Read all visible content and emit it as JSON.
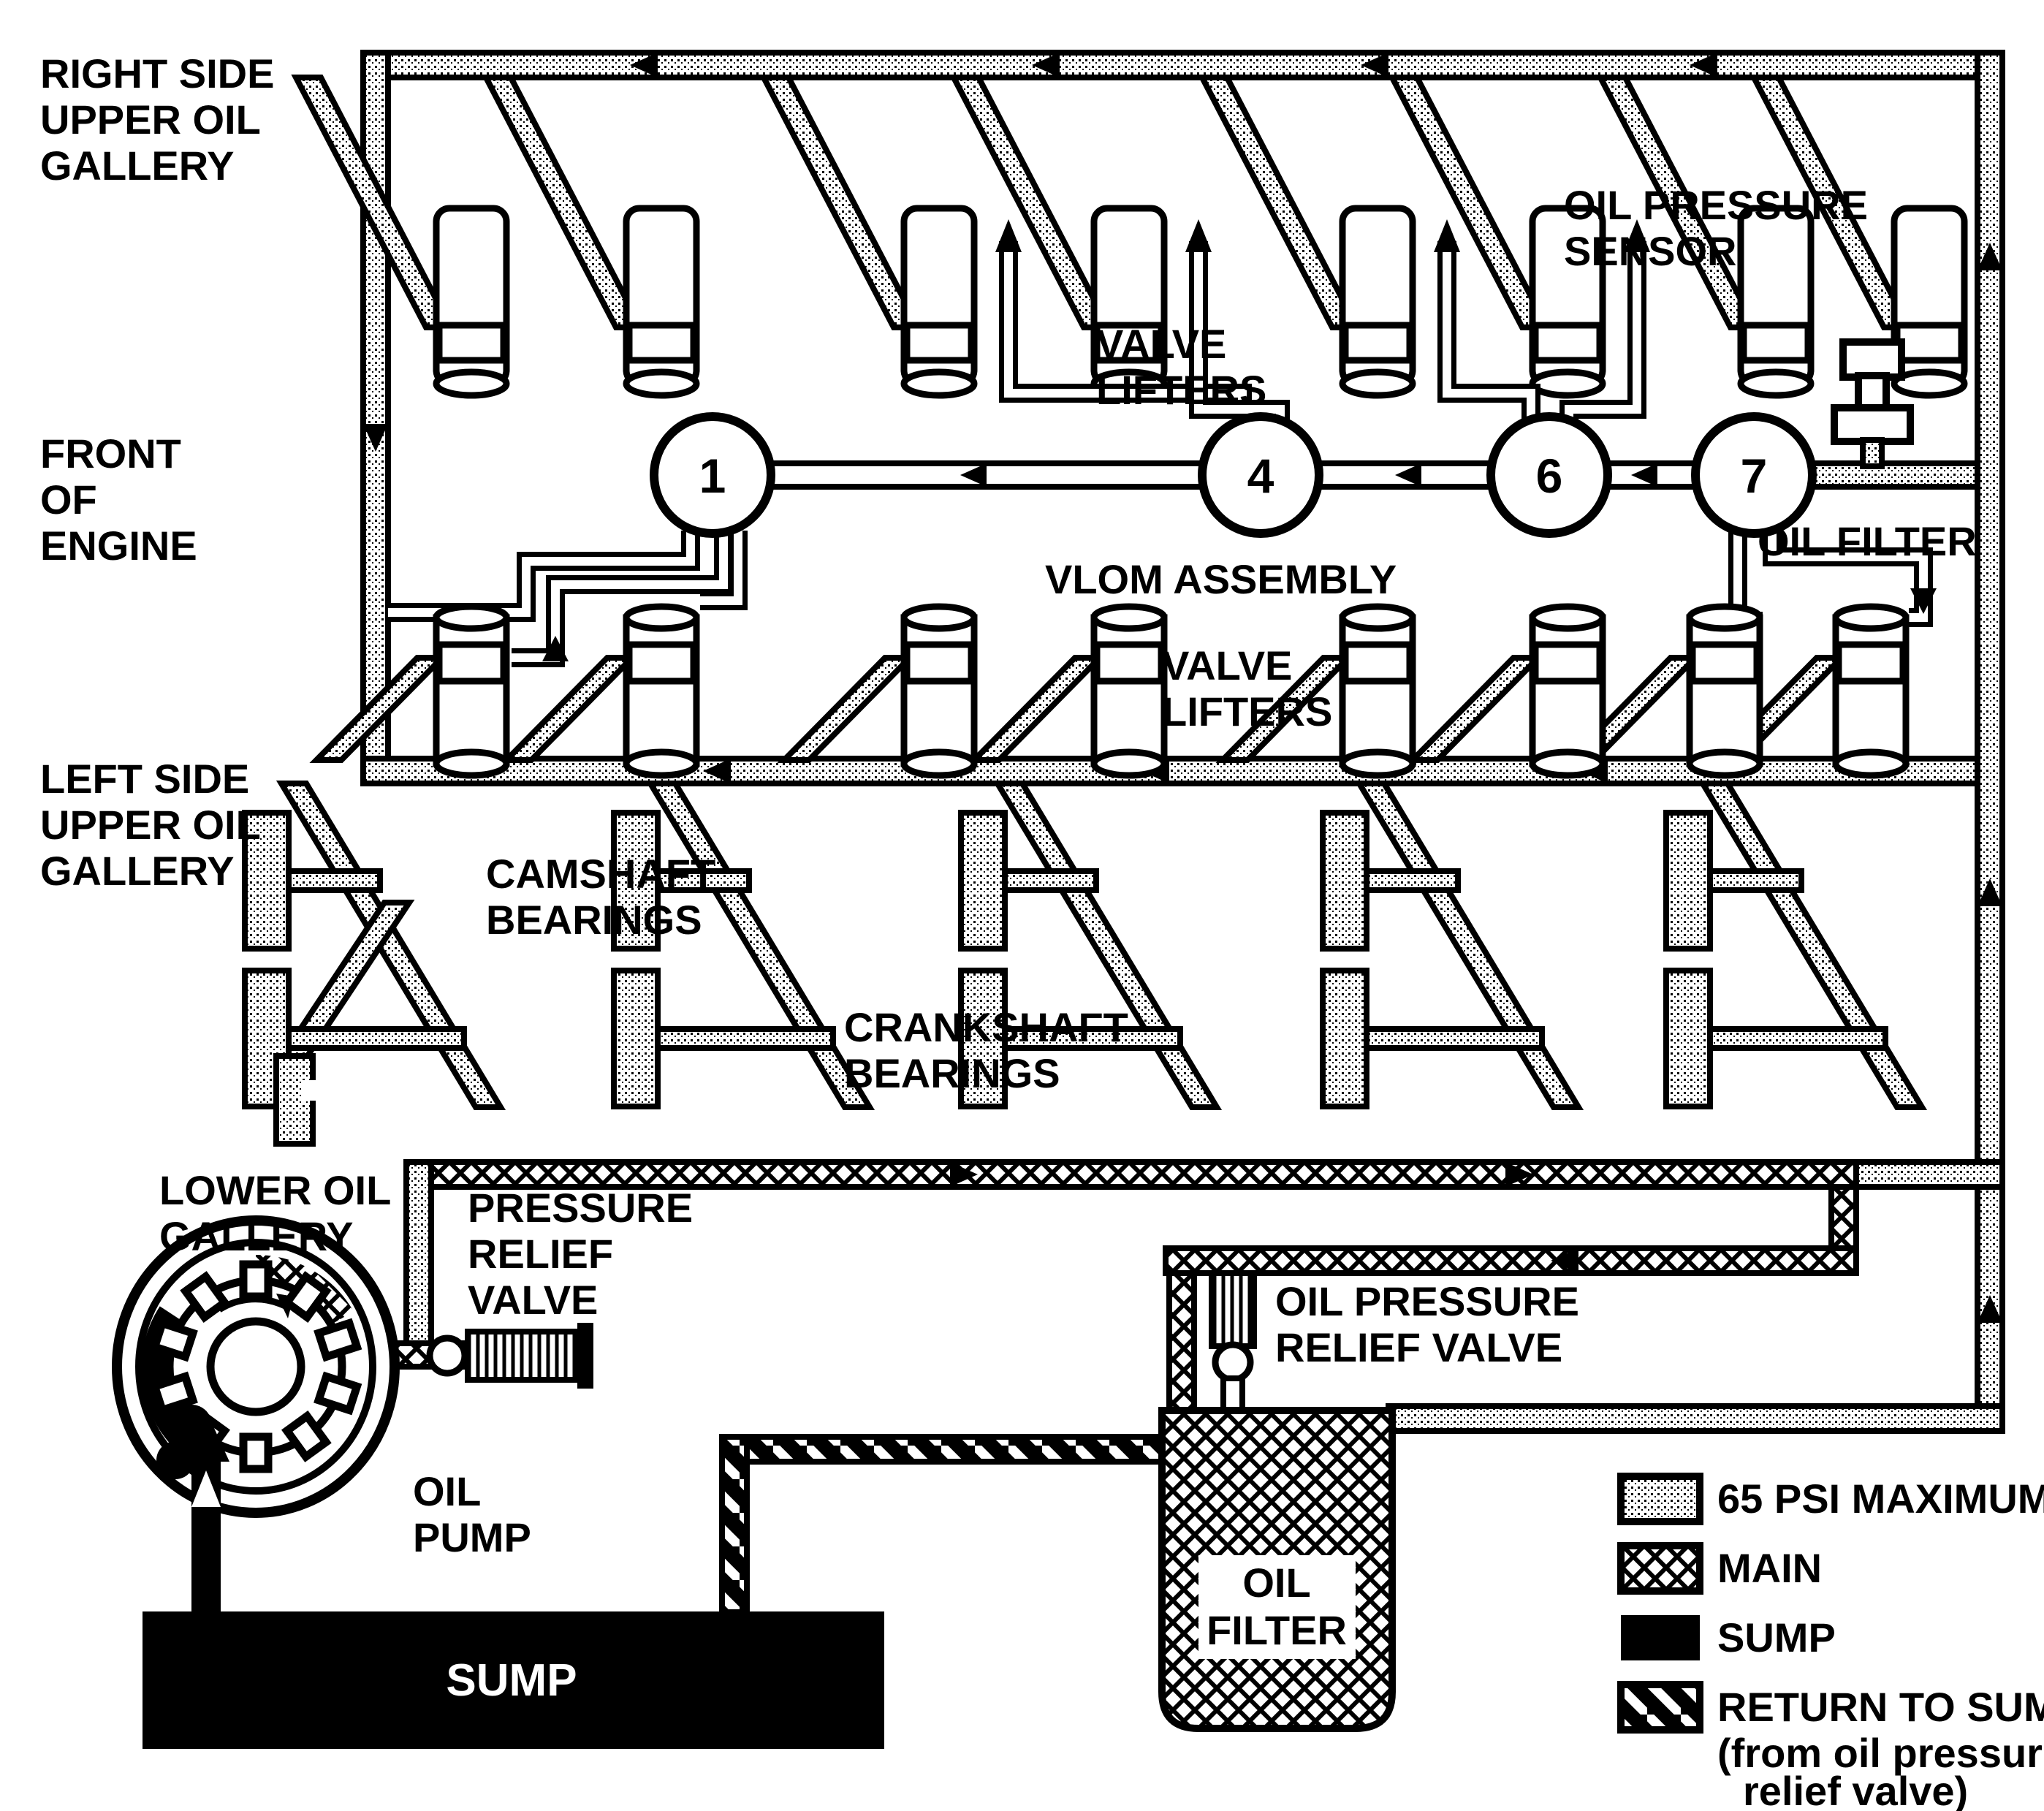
{
  "diagram_type": "engine-oil-flow-schematic",
  "colors": {
    "line": "#000000",
    "background": "#ffffff"
  },
  "labels": {
    "right_gallery": [
      "RIGHT SIDE",
      "UPPER OIL",
      "GALLERY"
    ],
    "front_engine": [
      "FRONT",
      "OF",
      "ENGINE"
    ],
    "left_gallery": [
      "LEFT SIDE",
      "UPPER OIL",
      "GALLERY"
    ],
    "valve_lifters_upper": [
      "VALVE",
      "LIFTERS"
    ],
    "valve_lifters_lower": [
      "VALVE",
      "LIFTERS"
    ],
    "oil_pressure_sensor": [
      "OIL PRESSURE",
      "SENSOR"
    ],
    "oil_filter_line": "OIL FILTER",
    "vlom_assembly": "VLOM ASSEMBLY",
    "camshaft_bearings": [
      "CAMSHAFT",
      "BEARINGS"
    ],
    "crankshaft_bearings": [
      "CRANKSHAFT",
      "BEARINGS"
    ],
    "lower_oil_gallery": [
      "LOWER OIL",
      "GALLERY"
    ],
    "pressure_relief_valve": [
      "PRESSURE",
      "RELIEF",
      "VALVE"
    ],
    "oil_pump": [
      "OIL",
      "PUMP"
    ],
    "sump": "SUMP",
    "oil_pressure_relief_valve": [
      "OIL PRESSURE",
      "RELIEF VALVE"
    ],
    "oil_filter_canister": [
      "OIL",
      "FILTER"
    ]
  },
  "vlom_nodes": [
    "1",
    "4",
    "6",
    "7"
  ],
  "legend": [
    {
      "pattern": "psi65-swatch",
      "label": "65 PSI MAXIMUM"
    },
    {
      "pattern": "main-swatch",
      "label": "MAIN"
    },
    {
      "pattern": "sump-swatch",
      "label": "SUMP"
    },
    {
      "pattern": "return-swatch",
      "label": "RETURN TO SUMP",
      "note1": "(from oil pressure",
      "note2": "relief valve)"
    }
  ]
}
